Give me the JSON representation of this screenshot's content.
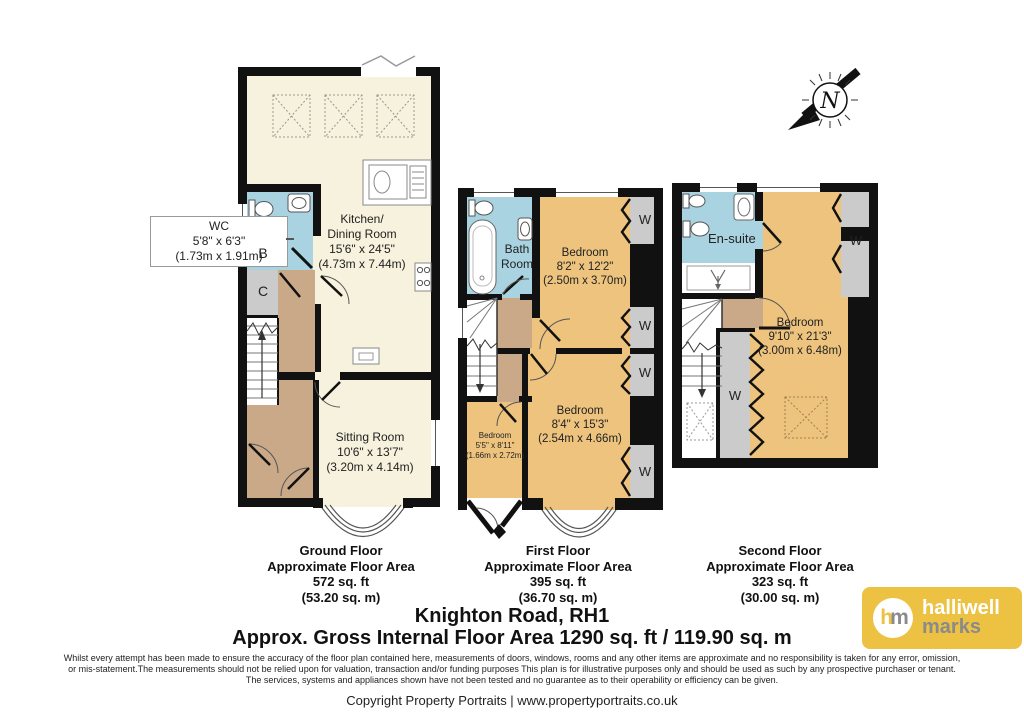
{
  "compass": {
    "letter": "N"
  },
  "wc_callout": {
    "text": "WC\n5'8\" x 6'3\"\n(1.73m x 1.91m)"
  },
  "rooms": {
    "kitchen": "Kitchen/\nDining Room\n15'6\" x 24'5\"\n(4.73m x 7.44m)",
    "sitting": "Sitting Room\n10'6\" x 13'7\"\n(3.20m x 4.14m)",
    "bath": "Bath\nRoom",
    "bedroom1": "Bedroom\n8'2\" x 12'2\"\n(2.50m x 3.70m)",
    "bedroom2": "Bedroom\n8'4\" x 15'3\"\n(2.54m x 4.66m)",
    "bedroom3": "Bedroom\n5'5\" x 8'11\"\n(1.66m x 2.72m)",
    "ensuite": "En-suite",
    "bedroom4": "Bedroom\n9'10\" x 21'3\"\n(3.00m x 6.48m)"
  },
  "markers": {
    "wardrobe": "W",
    "cupboard_b": "B",
    "cupboard_c": "C"
  },
  "floors": [
    {
      "name": "Ground Floor",
      "approx": "Approximate Floor Area",
      "sqft": "572 sq. ft",
      "sqm": "(53.20 sq. m)"
    },
    {
      "name": "First Floor",
      "approx": "Approximate Floor Area",
      "sqft": "395 sq. ft",
      "sqm": "(36.70 sq. m)"
    },
    {
      "name": "Second Floor",
      "approx": "Approximate Floor Area",
      "sqft": "323 sq. ft",
      "sqm": "(30.00 sq. m)"
    }
  ],
  "title": {
    "address": "Knighton Road, RH1",
    "gross": "Approx. Gross Internal Floor Area 1290 sq. ft / 119.90 sq. m"
  },
  "disclaimer": {
    "line1": "Whilst every attempt has been made to ensure the accuracy of the floor plan contained here, measurements of doors, windows, rooms and any other items are approximate and no responsibility is taken for any error, omission,",
    "line2": "or mis-statement.The measurements should not be relied upon for valuation, transaction and/or funding purposes This plan is for illustrative purposes only and should be used as such by any prospective purchaser or tenant.",
    "line3": "The services, systems and appliances shown have not been tested and no guarantee as to their operability or efficiency can be given."
  },
  "copyright": "Copyright Property Portraits | www.propertyportraits.co.uk",
  "logo": {
    "monogram_h": "h",
    "monogram_m": "m",
    "name_top": "halliwell",
    "name_bottom": "marks"
  },
  "colors": {
    "cream": "#F7F2DD",
    "blue": "#A9D3E1",
    "tan": "#C9A987",
    "orange": "#EDC37D",
    "gray": "#CBCBCB",
    "wall": "#111111",
    "gold": "#EDC243"
  }
}
